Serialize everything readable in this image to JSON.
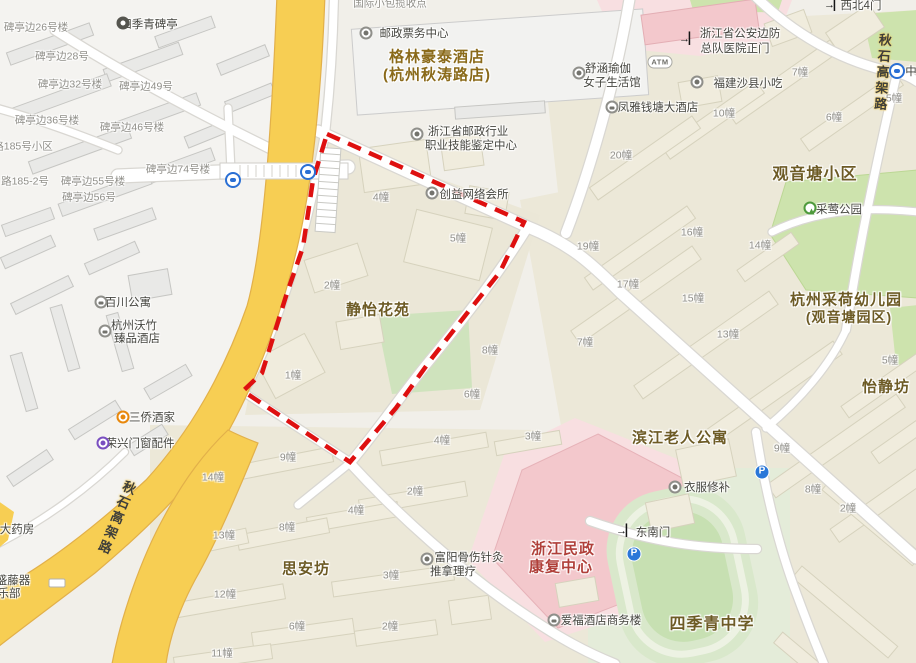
{
  "map": {
    "area_labels": [
      {
        "t": "观音塘小区",
        "x": 815,
        "y": 172,
        "s": 16
      },
      {
        "t": "静怡花苑",
        "x": 378,
        "y": 309,
        "s": 15
      },
      {
        "t": "杭州采荷幼儿园",
        "x": 846,
        "y": 299,
        "s": 15
      },
      {
        "t": "(观音塘园区)",
        "x": 849,
        "y": 317,
        "s": 14
      },
      {
        "t": "怡静坊",
        "x": 886,
        "y": 386,
        "s": 15
      },
      {
        "t": "滨江老人公寓",
        "x": 680,
        "y": 437,
        "s": 15
      },
      {
        "t": "思安坊",
        "x": 306,
        "y": 568,
        "s": 15
      },
      {
        "t": "四季青中学",
        "x": 712,
        "y": 622,
        "s": 16
      },
      {
        "t": "格林豪泰酒店",
        "x": 437,
        "y": 56,
        "s": 15,
        "c": "#8a6a1a"
      },
      {
        "t": "(杭州秋涛路店)",
        "x": 437,
        "y": 74,
        "s": 15,
        "c": "#8a6a1a"
      },
      {
        "t": "浙江民政",
        "x": 563,
        "y": 548,
        "s": 15,
        "c": "#b0403a"
      },
      {
        "t": "康复中心",
        "x": 561,
        "y": 566,
        "s": 15,
        "c": "#b0403a"
      }
    ],
    "poi_labels": [
      {
        "t": "四季青碑亭",
        "x": 149,
        "y": 24
      },
      {
        "t": "邮政票务中心",
        "x": 414,
        "y": 33
      },
      {
        "t": "浙江省邮政行业",
        "x": 468,
        "y": 131
      },
      {
        "t": "职业技能鉴定中心",
        "x": 471,
        "y": 145
      },
      {
        "t": "创益网络会所",
        "x": 474,
        "y": 194
      },
      {
        "t": "舒涵瑜伽",
        "x": 608,
        "y": 68
      },
      {
        "t": "女子生活馆",
        "x": 612,
        "y": 82
      },
      {
        "t": "浙江省公安边防",
        "x": 740,
        "y": 33
      },
      {
        "t": "总队医院正门",
        "x": 735,
        "y": 48
      },
      {
        "t": "福建沙县小吃",
        "x": 748,
        "y": 83
      },
      {
        "t": "凤雅钱塘大酒店",
        "x": 658,
        "y": 107
      },
      {
        "t": "采莺公园",
        "x": 839,
        "y": 209
      },
      {
        "t": "西北4门",
        "x": 861,
        "y": 5
      },
      {
        "t": "中",
        "x": 911,
        "y": 71
      },
      {
        "t": "百川公寓",
        "x": 128,
        "y": 302
      },
      {
        "t": "杭州沃竹",
        "x": 134,
        "y": 325
      },
      {
        "t": "臻品酒店",
        "x": 137,
        "y": 338
      },
      {
        "t": "三侨酒家",
        "x": 152,
        "y": 417
      },
      {
        "t": "荣兴门窗配件",
        "x": 140,
        "y": 443
      },
      {
        "t": "衣服修补",
        "x": 707,
        "y": 487
      },
      {
        "t": "东南门",
        "x": 653,
        "y": 532
      },
      {
        "t": "爱福酒店商务楼",
        "x": 601,
        "y": 620
      },
      {
        "t": "富阳骨伤针灸",
        "x": 469,
        "y": 557
      },
      {
        "t": "推拿理疗",
        "x": 453,
        "y": 571
      },
      {
        "t": "大药房",
        "x": 17,
        "y": 529
      },
      {
        "t": "盛藤器",
        "x": 13,
        "y": 580
      },
      {
        "t": "乐部",
        "x": 9,
        "y": 593
      }
    ],
    "building_labels": [
      {
        "t": "碑亭边26号楼",
        "x": 36,
        "y": 27
      },
      {
        "t": "碑亭边28号",
        "x": 62,
        "y": 56
      },
      {
        "t": "碑亭边32号楼",
        "x": 70,
        "y": 84
      },
      {
        "t": "碑亭边49号",
        "x": 146,
        "y": 86
      },
      {
        "t": "碑亭边36号楼",
        "x": 47,
        "y": 120
      },
      {
        "t": "碑亭边46号楼",
        "x": 132,
        "y": 127
      },
      {
        "t": "路185号小区",
        "x": 23,
        "y": 146
      },
      {
        "t": "碑亭边74号楼",
        "x": 178,
        "y": 169
      },
      {
        "t": "碑亭边55号楼",
        "x": 93,
        "y": 181
      },
      {
        "t": "路185-2号",
        "x": 25,
        "y": 181
      },
      {
        "t": "碑亭边56号",
        "x": 89,
        "y": 197
      },
      {
        "t": "国际小包揽收点",
        "x": 390,
        "y": 3
      },
      {
        "t": "4幢",
        "x": 381,
        "y": 197
      },
      {
        "t": "5幢",
        "x": 458,
        "y": 238
      },
      {
        "t": "2幢",
        "x": 332,
        "y": 285
      },
      {
        "t": "1幢",
        "x": 293,
        "y": 375
      },
      {
        "t": "8幢",
        "x": 490,
        "y": 350
      },
      {
        "t": "7幢",
        "x": 585,
        "y": 342
      },
      {
        "t": "6幢",
        "x": 472,
        "y": 394
      },
      {
        "t": "9幢",
        "x": 288,
        "y": 457
      },
      {
        "t": "14幢",
        "x": 213,
        "y": 477
      },
      {
        "t": "4幢",
        "x": 442,
        "y": 440
      },
      {
        "t": "3幢",
        "x": 533,
        "y": 436
      },
      {
        "t": "2幢",
        "x": 415,
        "y": 491
      },
      {
        "t": "4幢",
        "x": 356,
        "y": 510
      },
      {
        "t": "8幢",
        "x": 287,
        "y": 527
      },
      {
        "t": "13幢",
        "x": 224,
        "y": 535
      },
      {
        "t": "3幢",
        "x": 391,
        "y": 575
      },
      {
        "t": "12幢",
        "x": 225,
        "y": 594
      },
      {
        "t": "6幢",
        "x": 297,
        "y": 626
      },
      {
        "t": "2幢",
        "x": 390,
        "y": 626
      },
      {
        "t": "11幢",
        "x": 222,
        "y": 653
      },
      {
        "t": "7幢",
        "x": 800,
        "y": 72
      },
      {
        "t": "5幢",
        "x": 894,
        "y": 98
      },
      {
        "t": "10幢",
        "x": 724,
        "y": 113
      },
      {
        "t": "6幢",
        "x": 834,
        "y": 117
      },
      {
        "t": "20幢",
        "x": 621,
        "y": 155
      },
      {
        "t": "16幢",
        "x": 692,
        "y": 232
      },
      {
        "t": "14幢",
        "x": 760,
        "y": 245
      },
      {
        "t": "19幢",
        "x": 588,
        "y": 246
      },
      {
        "t": "17幢",
        "x": 628,
        "y": 284
      },
      {
        "t": "15幢",
        "x": 693,
        "y": 298
      },
      {
        "t": "13幢",
        "x": 728,
        "y": 334
      },
      {
        "t": "5幢",
        "x": 890,
        "y": 360
      },
      {
        "t": "9幢",
        "x": 782,
        "y": 448
      },
      {
        "t": "8幢",
        "x": 813,
        "y": 489
      },
      {
        "t": "2幢",
        "x": 848,
        "y": 508
      }
    ],
    "road_labels": [
      {
        "t": "秋石高架路",
        "x": 882,
        "y": 73,
        "rot": 4
      },
      {
        "t": "秋石高架路",
        "x": 116,
        "y": 518,
        "rot": 22
      }
    ],
    "icons": [
      {
        "type": "poi",
        "x": 123,
        "y": 23,
        "variant": "dark"
      },
      {
        "type": "poi",
        "x": 366,
        "y": 33
      },
      {
        "type": "poi",
        "x": 417,
        "y": 134
      },
      {
        "type": "poi",
        "x": 432,
        "y": 193
      },
      {
        "type": "poi",
        "x": 579,
        "y": 73
      },
      {
        "type": "gate",
        "x": 688,
        "y": 39
      },
      {
        "type": "atm",
        "x": 660,
        "y": 62,
        "label": "ATM"
      },
      {
        "type": "poi",
        "x": 697,
        "y": 82
      },
      {
        "type": "hotel",
        "x": 612,
        "y": 107
      },
      {
        "type": "park",
        "x": 810,
        "y": 208
      },
      {
        "type": "gate",
        "x": 833,
        "y": 5
      },
      {
        "type": "metro",
        "x": 897,
        "y": 71
      },
      {
        "type": "hotel",
        "x": 101,
        "y": 302
      },
      {
        "type": "hotel",
        "x": 105,
        "y": 331
      },
      {
        "type": "poi",
        "x": 123,
        "y": 417,
        "variant": "orange"
      },
      {
        "type": "poi",
        "x": 103,
        "y": 443,
        "variant": "purple"
      },
      {
        "type": "poi",
        "x": 675,
        "y": 487
      },
      {
        "type": "gate",
        "x": 625,
        "y": 531
      },
      {
        "type": "hotel",
        "x": 554,
        "y": 620
      },
      {
        "type": "poi",
        "x": 427,
        "y": 559
      },
      {
        "type": "bus",
        "x": 233,
        "y": 180
      },
      {
        "type": "bus",
        "x": 308,
        "y": 172
      },
      {
        "type": "parking",
        "x": 762,
        "y": 472,
        "label": "P"
      },
      {
        "type": "parking",
        "x": 634,
        "y": 554,
        "label": "P"
      },
      {
        "type": "roadbadge",
        "x": 57,
        "y": 583
      }
    ],
    "highlight_zone": {
      "color": "#de1010",
      "points": [
        [
          327,
          134
        ],
        [
          524,
          222
        ],
        [
          500,
          272
        ],
        [
          468,
          312
        ],
        [
          432,
          358
        ],
        [
          396,
          408
        ],
        [
          350,
          462
        ],
        [
          243,
          391
        ],
        [
          262,
          373
        ],
        [
          287,
          293
        ],
        [
          303,
          247
        ],
        [
          313,
          180
        ],
        [
          327,
          134
        ]
      ]
    },
    "palette": {
      "highway_yellow": "#f7ce53",
      "road_white": "#ffffff",
      "park_green": "#cde3ad",
      "hospital_pink": "#f3c8cc",
      "area_label": "#6d5b25",
      "building_label": "#8f8e88"
    }
  }
}
